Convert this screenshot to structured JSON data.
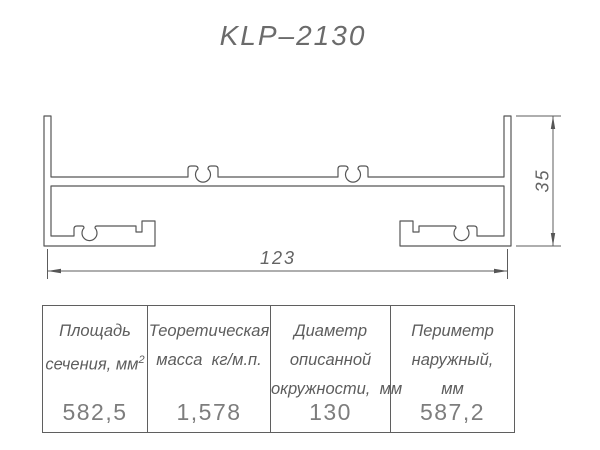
{
  "title": "KLP–2130",
  "dimensions": {
    "width": "123",
    "height": "35"
  },
  "table": {
    "columns": [
      {
        "header_lines": [
          "Площадь",
          "сечения, мм"
        ],
        "header_sup": "2",
        "value": "582,5"
      },
      {
        "header_lines": [
          "Теоретическая",
          "масса  кг/м.п."
        ],
        "value": "1,578"
      },
      {
        "header_lines": [
          "Диаметр",
          "описанной",
          "окружности,  мм"
        ],
        "value": "130"
      },
      {
        "header_lines": [
          "Периметр",
          "наружный,",
          "мм"
        ],
        "value": "587,2"
      }
    ]
  },
  "colors": {
    "line": "#565656",
    "header_text": "#5d5d5d",
    "value_text": "#7d7d7d",
    "background": "#ffffff"
  }
}
